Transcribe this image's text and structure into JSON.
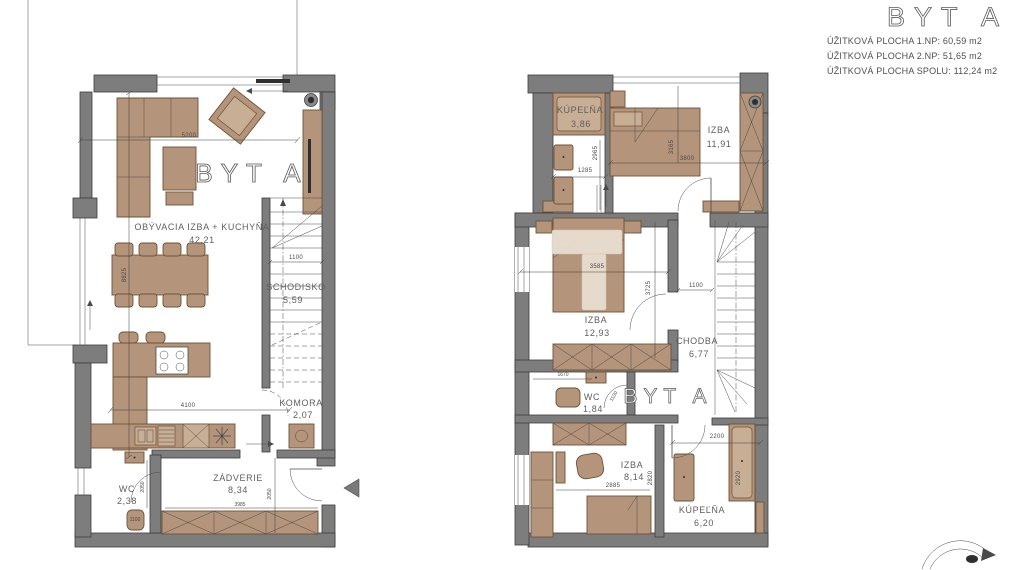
{
  "header": {
    "title": "BYT A",
    "lines": [
      "ÚŽITKOVÁ PLOCHA 1.NP: 60,59 m2",
      "ÚŽITKOVÁ PLOCHA 2.NP: 51,65 m2",
      "ÚŽITKOVÁ PLOCHA SPOLU: 112,24 m2"
    ]
  },
  "plan1": {
    "apartment_label": "BYT A",
    "living": {
      "name": "OBÝVACIA IZBA + KUCHYŇA",
      "area": "42,21"
    },
    "stairs": {
      "name": "SCHODISKO",
      "area": "5,59"
    },
    "komora": {
      "name": "KOMORA",
      "area": "2,07"
    },
    "zadverie": {
      "name": "ZÁDVERIE",
      "area": "8,34"
    },
    "wc": {
      "name": "WC",
      "area": "2,38"
    },
    "dims": {
      "d5200": "5200",
      "d8825": "8825",
      "d4100": "4100",
      "d1100s": "1100",
      "d3985": "3985",
      "d2050z": "2050",
      "d2050w": "2050",
      "d1100w": "1100"
    }
  },
  "plan2": {
    "apartment_label": "BYT A",
    "kupelna1": {
      "name": "KÚPEĽŇA",
      "area": "3,86"
    },
    "izba1": {
      "name": "IZBA",
      "area": "11,91"
    },
    "izba2": {
      "name": "IZBA",
      "area": "12,93"
    },
    "chodba": {
      "name": "CHODBA",
      "area": "6,77"
    },
    "wc": {
      "name": "WC",
      "area": "1,84"
    },
    "izba3": {
      "name": "IZBA",
      "area": "8,14"
    },
    "kupelna2": {
      "name": "KÚPEĽŇA",
      "area": "6,20"
    },
    "dims": {
      "d2965": "2965",
      "d1285": "1285",
      "d3165": "3165",
      "d3800": "3800",
      "d3585": "3585",
      "d3725": "3725",
      "d1100c": "1100",
      "d1670": "1670",
      "d1100w": "1100",
      "d2885": "2885",
      "d2820": "2820",
      "d2200": "2200",
      "d2920": "2920"
    }
  }
}
